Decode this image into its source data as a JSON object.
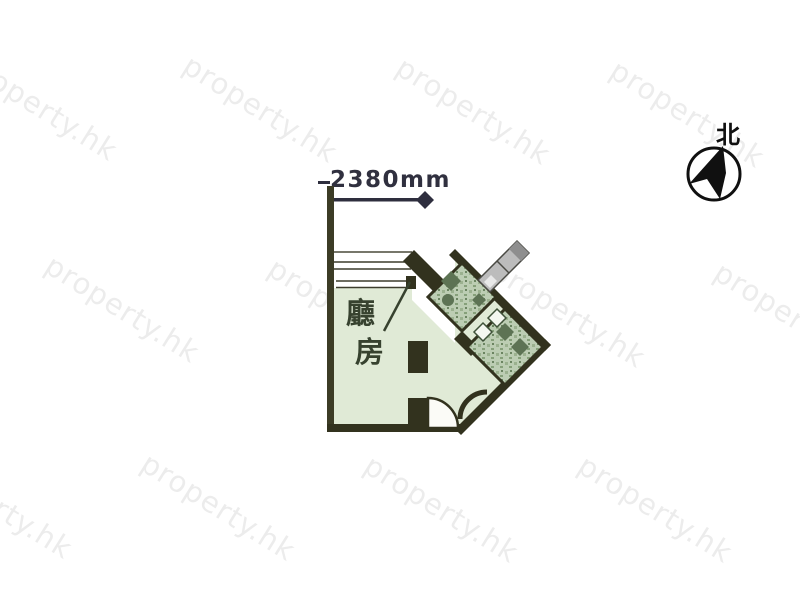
{
  "watermark": {
    "text": "property.hk",
    "color": "rgba(40,40,40,0.085)",
    "positions": [
      {
        "x": -25,
        "y": 46
      },
      {
        "x": 195,
        "y": 48
      },
      {
        "x": 408,
        "y": 50
      },
      {
        "x": 622,
        "y": 53
      },
      {
        "x": 57,
        "y": 248
      },
      {
        "x": 280,
        "y": 251
      },
      {
        "x": 503,
        "y": 253
      },
      {
        "x": 726,
        "y": 255
      },
      {
        "x": -70,
        "y": 444
      },
      {
        "x": 153,
        "y": 446
      },
      {
        "x": 376,
        "y": 448
      },
      {
        "x": 590,
        "y": 448
      }
    ]
  },
  "dimension": {
    "label": "2380mm"
  },
  "compass": {
    "north_label": "北"
  },
  "floor_plan": {
    "living_label": "廳",
    "bed_label": "房"
  },
  "colors": {
    "wall": "#32321e",
    "left_wall": "#3c3c26",
    "room_fill": "#e0ead6",
    "wet_room_fill": "#bccdb3",
    "duct_fill": "#bcbcbc",
    "dimension_color": "#2e2e3e"
  }
}
